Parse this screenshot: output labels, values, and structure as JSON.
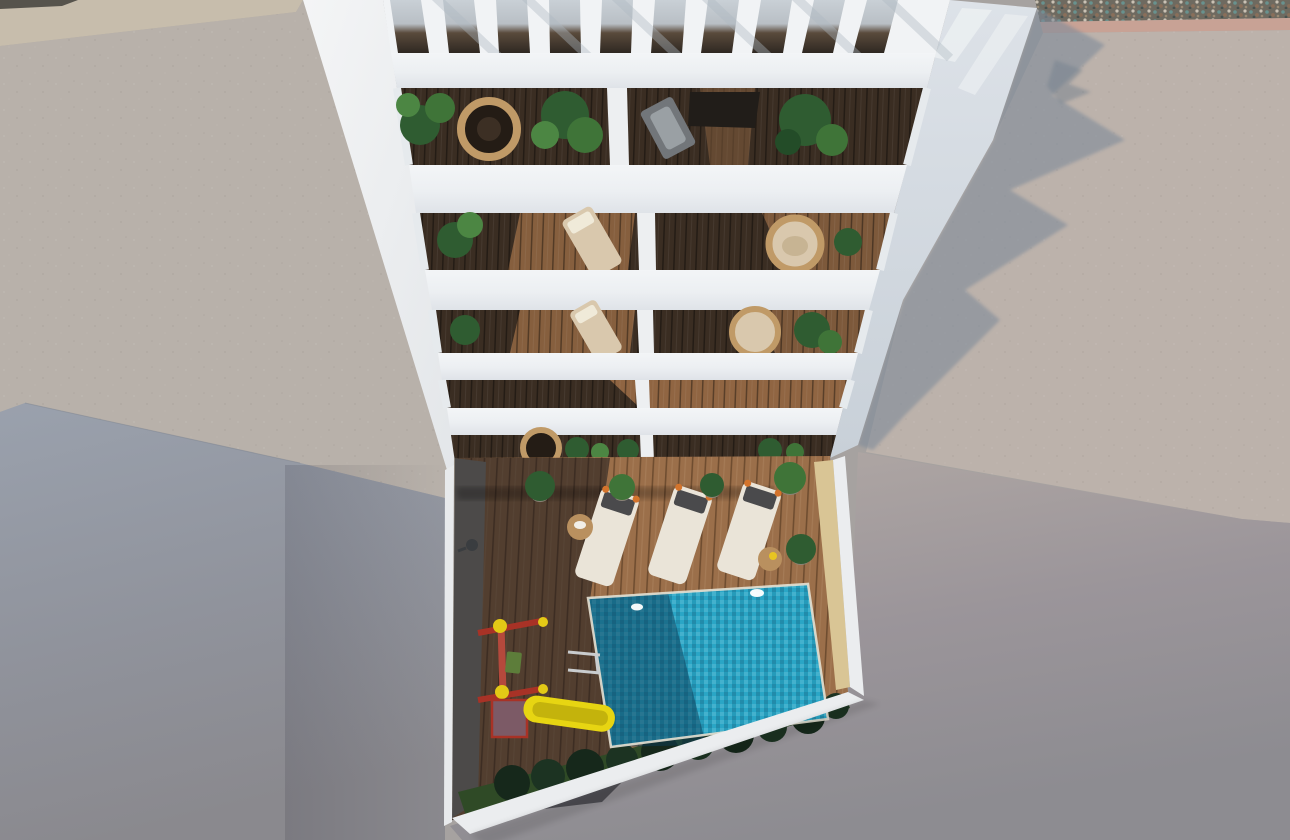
{
  "scene": {
    "kind": "architectural 3d render",
    "view": "aerial top-down view of a white apartment building with stacked balconies, a rooftop pergola, and a private courtyard with swimming pool, sun loungers and a children's playground",
    "time_of_day": "bright sunlight with long diagonal shadows"
  },
  "colors": {
    "building_white": "#f1f3f5",
    "slab_face": "#e4e8ec",
    "left_wall_white": "#eef0f2",
    "wall_shade_band": "#d5dbe1",
    "divider_white": "#edeff1",
    "concrete_left": "#b8b1aa",
    "beige_strip": "#c7bdac",
    "pebble_base": "#72706a",
    "pebble_dark": "#56534c",
    "pink_band": "#c8a295",
    "concrete_right": "#bcb2ab",
    "cast_shadow_blue": "#7f8b9a",
    "lowerleft_gray": "#9aa1ad",
    "street_gray": "#95949a",
    "balcony_floor_dark": "#3a2d22",
    "balcony_floor_lit": "#9a6c46",
    "deck_wood": "#9b6f4a",
    "deck_shadow": "#101217",
    "pool_water": "#2aa6c6",
    "pool_shadow": "#0b3c55",
    "sand_wall": "#d9c595",
    "courtyard_wall_white": "#ebedef",
    "left_wall_face": "#8f887f",
    "grass": "#2f4a26",
    "bush_green": "#16281b",
    "plant_green": "#2f5c31",
    "plant_light": "#4c8643",
    "wicker_tan": "#c09a67",
    "cushion_beige": "#d9c8ad",
    "lounger_cream": "#eae4d8",
    "lounger_pillow": "#4a4a4c",
    "lounger_orange": "#d4742c",
    "table_wood": "#b9905f",
    "gray_chair": "#72767a",
    "cabinet_dark": "#211d19",
    "slide_yellow": "#e7d512",
    "slide_shade": "#c4b30c",
    "play_red": "#a83226",
    "play_cap_yellow": "#e3c916",
    "platform_purple": "#7c5a66",
    "ladder_silver": "#c9ccce",
    "pool_light": "#ffffff"
  },
  "objects": {
    "building": {
      "pergola_slat_gaps": 10,
      "balcony_levels": 5,
      "units_per_level": 2,
      "balcony_items": [
        "hanging wicker chairs",
        "papasan chairs",
        "beige loungers",
        "banana plants",
        "palms",
        "gray sling chair",
        "dark cabinet"
      ]
    },
    "courtyard": {
      "pool": {
        "underwater_lights": 2,
        "ladders": 1,
        "shape": "rectangular, rotated"
      },
      "sun_loungers": 3,
      "side_tables": 2,
      "potted_plants": 5,
      "hedge_bushes": 10,
      "playground": {
        "slide": 1,
        "swing_frame": 1,
        "platform": 1
      },
      "wall_fixture": "outdoor tap"
    },
    "surroundings": [
      "concrete plaza left",
      "concrete plaza right",
      "gravel strip",
      "gray streets",
      "building cast shadow"
    ]
  }
}
